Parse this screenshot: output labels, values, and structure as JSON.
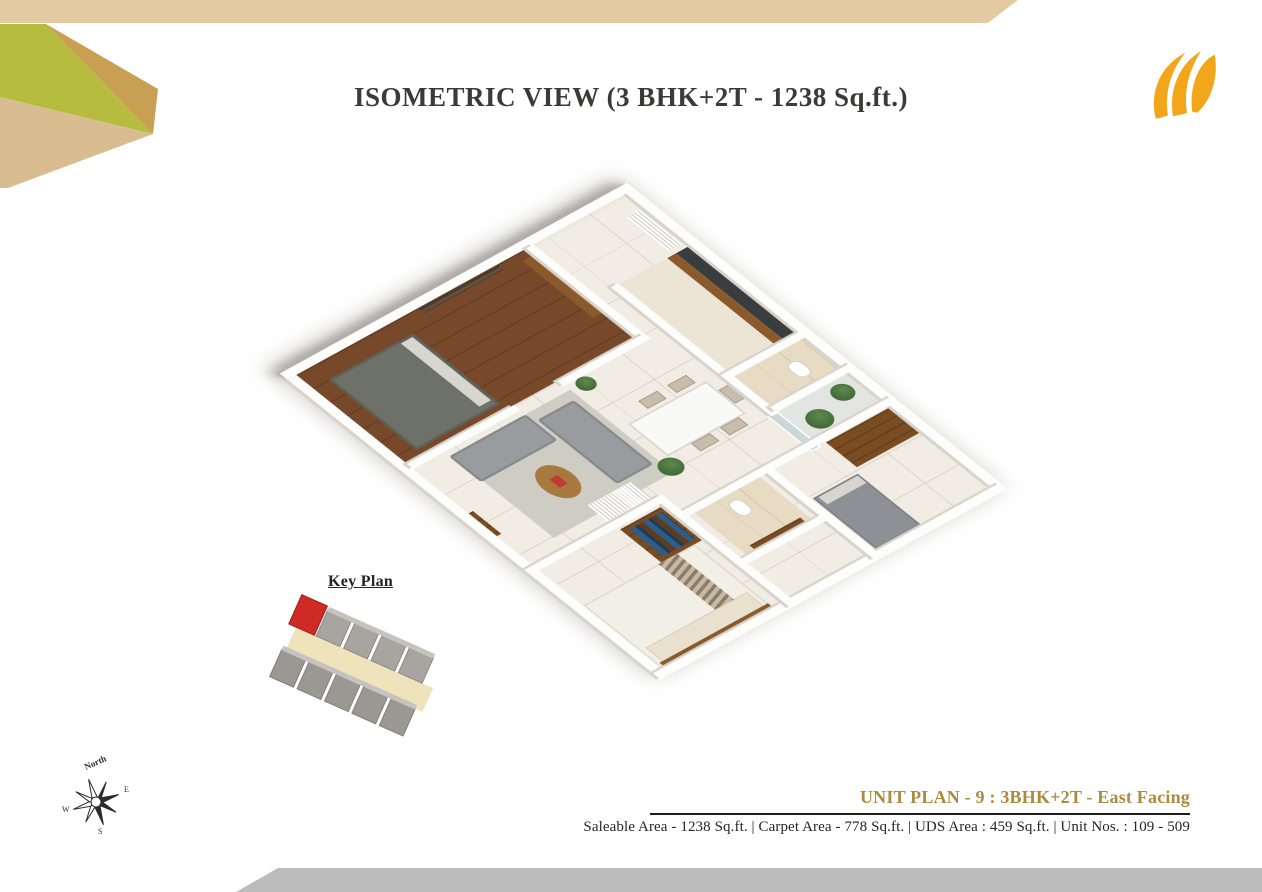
{
  "header": {
    "title": "ISOMETRIC VIEW (3 BHK+2T - 1238 Sq.ft.)"
  },
  "key_plan": {
    "label": "Key Plan"
  },
  "compass": {
    "north_label": "North",
    "east": "E",
    "west": "W",
    "south": "S"
  },
  "footer": {
    "unit_plan_title": "UNIT PLAN - 9 : 3BHK+2T - East Facing",
    "area_details": "Saleable Area - 1238 Sq.ft. | Carpet Area - 778 Sq.ft. | UDS Area : 459 Sq.ft. | Unit Nos. : 109 - 509"
  },
  "colors": {
    "accent_gold": "#ab8b3e",
    "strip_tan": "#e3caa3",
    "tri_lime": "#b6bc3d",
    "tri_gold": "#c9a053",
    "tri_tan": "#d9bc90",
    "logo_gold": "#f2a71b",
    "bottom_bar_gray": "#bcbcbc",
    "keyplan_unit_red": "#cf2b24",
    "title_ink": "#3b3a38",
    "text_ink": "#262626"
  }
}
